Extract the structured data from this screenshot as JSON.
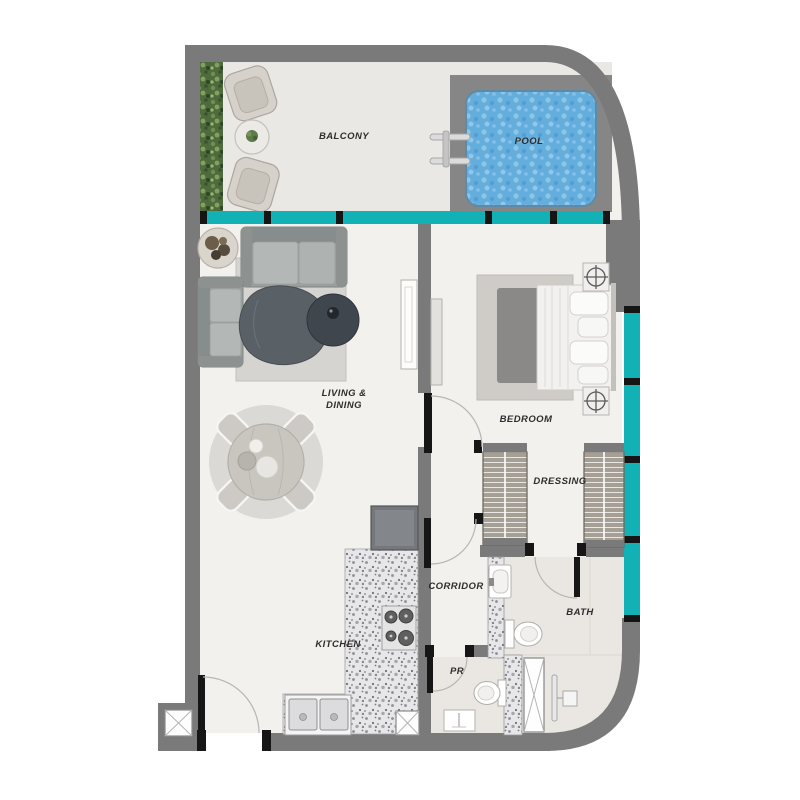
{
  "rooms": {
    "balcony": "BALCONY",
    "pool": "POOL",
    "living_line1": "LIVING &",
    "living_line2": "DINING",
    "bedroom": "BEDROOM",
    "dressing": "DRESSING",
    "corridor": "CORRIDOR",
    "bath": "BATH",
    "pr": "PR",
    "kitchen": "KITCHEN"
  },
  "colors": {
    "wall": "#7a7a7a",
    "window": "#12b1b6",
    "mullion": "#151515",
    "floor_interior": "#f2f1ee",
    "floor_balcony": "#e9e8e5",
    "floor_tile": "#eae6e1",
    "pool_water": "#64aedd"
  }
}
